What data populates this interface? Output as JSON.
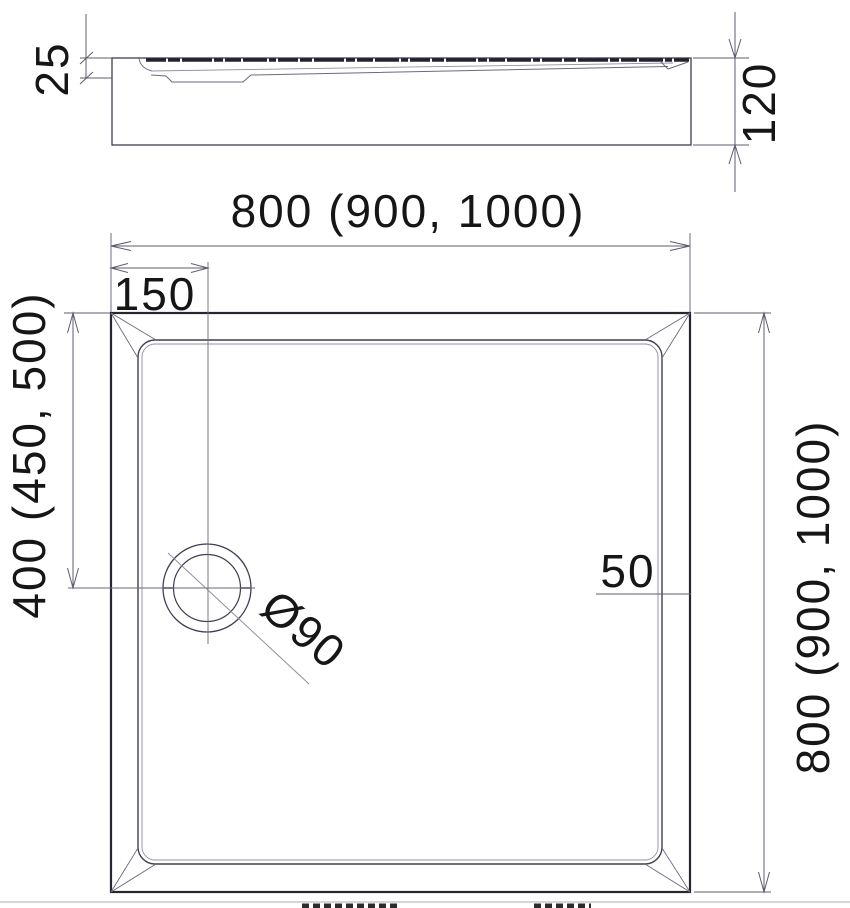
{
  "page": {
    "background": "#ffffff",
    "bottom_divider_color": "#c9c9cf"
  },
  "drawing": {
    "kind": "shower-tray-dimension-drawing",
    "line_color": "#3f3f52",
    "dim_line_color": "#5c5c6e",
    "text_color": "#161616",
    "side_view": {
      "rim_height_label": "25",
      "total_height_label": "120"
    },
    "plan_view": {
      "width_label": "800 (900, 1000)",
      "depth_label": "800 (900, 1000)",
      "drain_offset_left_label": "150",
      "drain_offset_top_label": "400 (450, 500)",
      "drain_diameter_label": "Ø90",
      "rim_width_label": "50"
    }
  }
}
